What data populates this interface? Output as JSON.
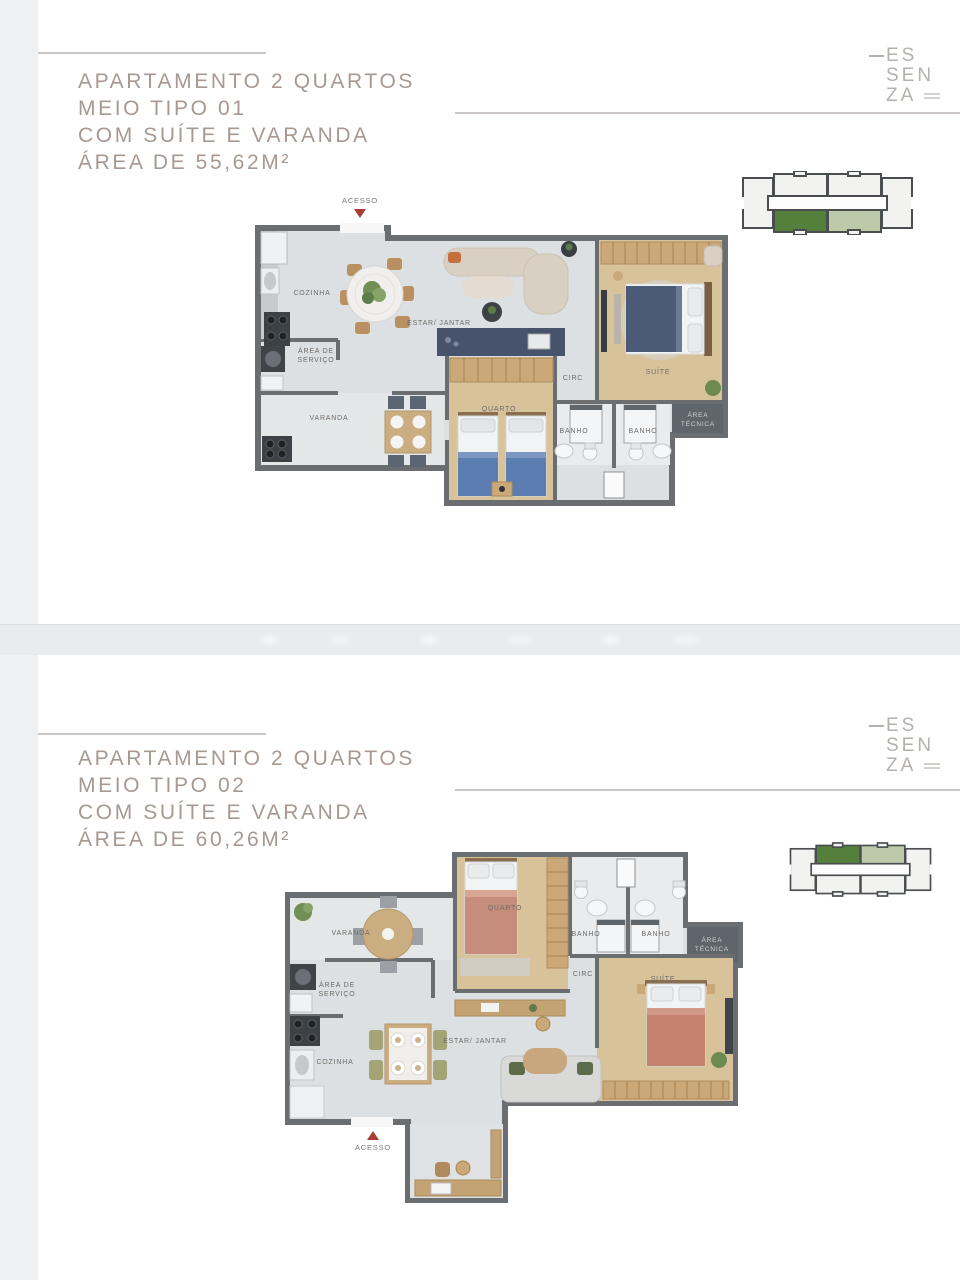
{
  "colors": {
    "title_text": "#a79892",
    "rule_line": "#cbc7c4",
    "logo_text": "#b6b0ac",
    "accent_red_arrow": "#a83e36",
    "keyplan_dark_green": "#55803c",
    "keyplan_light_green": "#bccaa9",
    "plan_wall": "#6a6e71",
    "plan_tile_floor": "#dce0e2",
    "plan_wood_floor": "#d8c29a",
    "plan_navy_panel": "#46536a",
    "watermark_band": "#e9ebee"
  },
  "logo": {
    "line1": "ES",
    "line2": "SEN",
    "line3": "ZA"
  },
  "slide1": {
    "title_line1": "APARTAMENTO 2 QUARTOS",
    "title_line2": "MEIO TIPO 01",
    "title_line3": "COM SUÍTE E VARANDA",
    "title_line4": "ÁREA DE 55,62M²",
    "plan": {
      "acesso": "ACESSO",
      "cozinha": "COZINHA",
      "estar_jantar": "ESTAR/ JANTAR",
      "area_servico_line1": "ÁREA DE",
      "area_servico_line2": "SERVIÇO",
      "varanda": "VARANDA",
      "quarto": "QUARTO",
      "circ": "CIRC",
      "banho_left": "BANHO",
      "banho_right": "BANHO",
      "suite": "SUÍTE",
      "area_tecnica_line1": "ÁREA",
      "area_tecnica_line2": "TÉCNICA"
    }
  },
  "slide2": {
    "title_line1": "APARTAMENTO 2 QUARTOS",
    "title_line2": "MEIO TIPO 02",
    "title_line3": "COM SUÍTE E VARANDA",
    "title_line4": "ÁREA DE 60,26M²",
    "plan": {
      "acesso": "ACESSO",
      "cozinha": "COZINHA",
      "estar_jantar": "ESTAR/ JANTAR",
      "area_servico_line1": "ÁREA DE",
      "area_servico_line2": "SERVIÇO",
      "varanda": "VARANDA",
      "quarto": "QUARTO",
      "circ": "CIRC",
      "banho_left": "BANHO",
      "banho_right": "BANHO",
      "suite": "SUÍTE",
      "area_tecnica_line1": "ÁREA",
      "area_tecnica_line2": "TÉCNICA"
    }
  }
}
